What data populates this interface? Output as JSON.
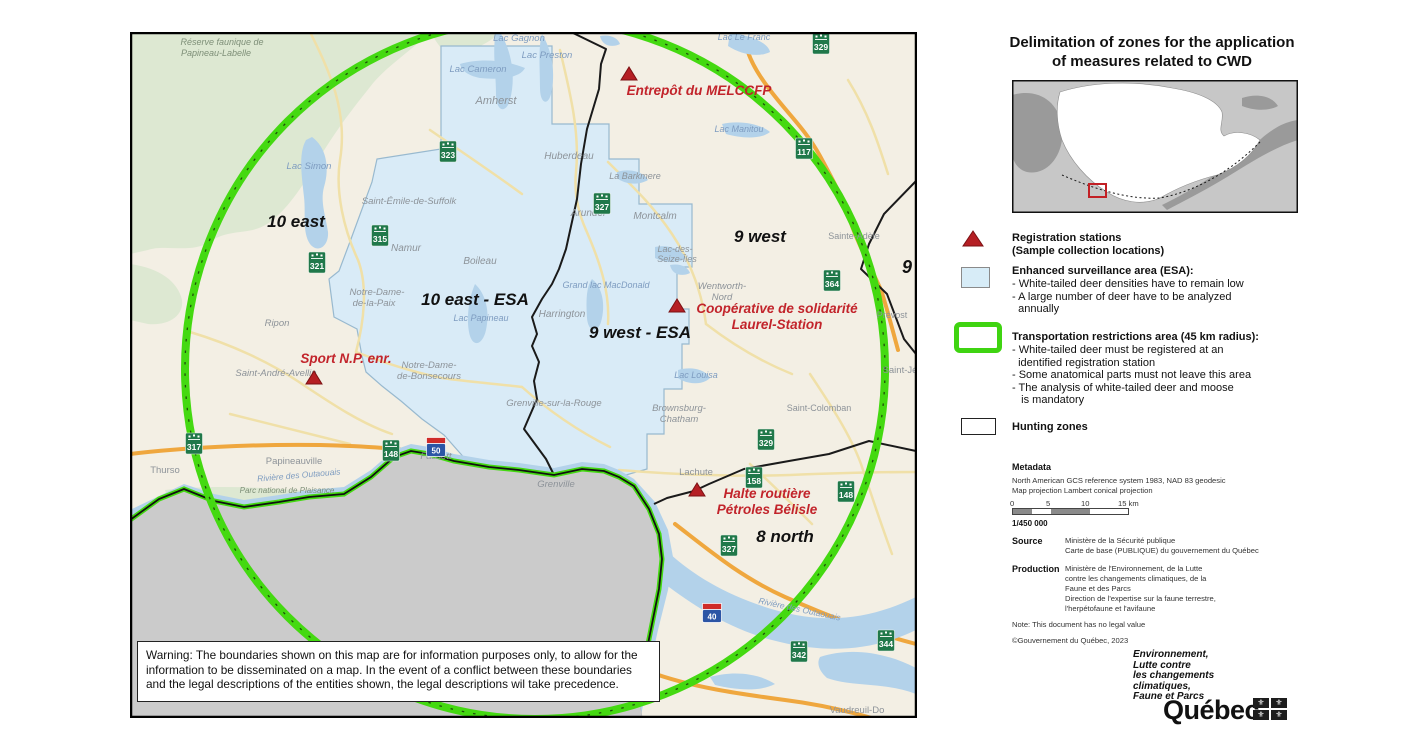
{
  "title": {
    "line1": "Delimitation of zones for the application",
    "line2": "of measures related to CWD"
  },
  "legend": {
    "registration_line1": "Registration stations",
    "registration_line2": "(Sample collection locations)",
    "esa_header": "Enhanced surveillance area (ESA):",
    "esa_items": [
      "- White-tailed deer densities have to remain low",
      "- A large number of deer have to be analyzed",
      "  annually"
    ],
    "transport_header": "Transportation restrictions area (45 km radius):",
    "transport_items": [
      "- White-tailed deer must be registered at an",
      "  identified registration station",
      "- Some anatomical parts must not leave this area",
      "- The analysis of white-tailed deer and moose",
      "   is mandatory"
    ],
    "hunting_label": "Hunting zones"
  },
  "metadata": {
    "header": "Metadata",
    "line1": "North American GCS reference system 1983, NAD 83 geodesic",
    "line2": "Map projection Lambert conical projection",
    "scale_ticks": [
      "0",
      "5",
      "10",
      "15 km"
    ],
    "scale_ratio": "1/450 000",
    "source_label": "Source",
    "source_lines": [
      "Ministère de la Sécurité publique",
      "Carte de base (PUBLIQUE) du gouvernement du Québec"
    ],
    "production_label": "Production",
    "production_lines": [
      "Ministère de l'Environnement, de la Lutte",
      "contre les changements climatiques, de la",
      "Faune et des Parcs",
      "Direction de l'expertise sur la faune terrestre,",
      "l'herpétofaune et l'avifaune"
    ],
    "note": "Note: This document has no legal value",
    "copyright": "©Gouvernement du Québec, 2023"
  },
  "logo": {
    "lines": [
      "Environnement,",
      "Lutte contre",
      "les changements",
      "climatiques,",
      "Faune et Parcs"
    ],
    "wordmark": "Québec",
    "fleur": "⚜"
  },
  "warning": {
    "lines": [
      "Warning: The boundaries shown on this map are for information purposes only, to allow for the",
      "information to be disseminated on a map. In the event of a conflict between these boundaries",
      "and the legal descriptions of the entities shown, the legal descriptions wil take precedence."
    ]
  },
  "map": {
    "colors": {
      "circle_green": "#44d911",
      "esa_fill": "#d9ebf7",
      "station_red": "#c2242b",
      "shield_green": "#20784a",
      "autoroute_blue": "#2c55a5",
      "autoroute_red": "#cf2b28",
      "ontario_gray": "#cbcbcb"
    },
    "zones": [
      {
        "t": "10 east",
        "x": 166,
        "y": 195,
        "s": 17
      },
      {
        "t": "10 east - ESA",
        "x": 345,
        "y": 273,
        "s": 17
      },
      {
        "t": "9 west",
        "x": 630,
        "y": 210,
        "s": 17
      },
      {
        "t": "9 west - ESA",
        "x": 510,
        "y": 306,
        "s": 17
      },
      {
        "t": "8 north",
        "x": 655,
        "y": 510,
        "s": 17
      },
      {
        "t": "9",
        "x": 777,
        "y": 241,
        "s": 18
      }
    ],
    "stations": [
      {
        "tx": 499,
        "ty": 43,
        "lines": [
          {
            "t": "Entrepôt du MELCCFP",
            "x": 569,
            "y": 63
          }
        ]
      },
      {
        "tx": 547,
        "ty": 275,
        "lines": [
          {
            "t": "Coopérative de solidarité",
            "x": 647,
            "y": 281
          },
          {
            "t": "Laurel-Station",
            "x": 647,
            "y": 297
          }
        ]
      },
      {
        "tx": 184,
        "ty": 347,
        "lines": [
          {
            "t": "Sport N.P. enr.",
            "x": 216,
            "y": 331
          }
        ]
      },
      {
        "tx": 567,
        "ty": 459,
        "lines": [
          {
            "t": "Halte routière",
            "x": 637,
            "y": 466
          },
          {
            "t": "Pétroles Bélisle",
            "x": 637,
            "y": 482
          }
        ]
      }
    ],
    "towns": [
      {
        "t": "Amherst",
        "x": 366,
        "y": 72,
        "s": 11,
        "it": 1
      },
      {
        "t": "Huberdeau",
        "x": 439,
        "y": 127,
        "s": 10,
        "it": 1
      },
      {
        "t": "La Barkmere",
        "x": 505,
        "y": 147,
        "s": 9,
        "it": 1
      },
      {
        "t": "Arundel",
        "x": 458,
        "y": 184,
        "s": 10,
        "it": 1
      },
      {
        "t": "Montcalm",
        "x": 525,
        "y": 187,
        "s": 10,
        "it": 1
      },
      {
        "t": "Saint-Émile-de-Suffolk",
        "x": 279,
        "y": 172,
        "s": 9.5,
        "it": 1
      },
      {
        "t": "Namur",
        "x": 276,
        "y": 219,
        "s": 10,
        "it": 1
      },
      {
        "t": "Boileau",
        "x": 350,
        "y": 232,
        "s": 10,
        "it": 1
      },
      {
        "t": "Notre-Dame-",
        "x": 247,
        "y": 263,
        "s": 9.5,
        "it": 1
      },
      {
        "t": "de-la-Paix",
        "x": 244,
        "y": 274,
        "s": 9.5,
        "it": 1
      },
      {
        "t": "Ripon",
        "x": 147,
        "y": 294,
        "s": 9.5,
        "it": 1
      },
      {
        "t": "Saint-André-Avellin",
        "x": 146,
        "y": 344,
        "s": 9.5,
        "it": 1
      },
      {
        "t": "Notre-Dame-",
        "x": 299,
        "y": 336,
        "s": 9.5,
        "it": 1
      },
      {
        "t": "de-Bonsecours",
        "x": 299,
        "y": 347,
        "s": 9.5,
        "it": 1
      },
      {
        "t": "Harrington",
        "x": 432,
        "y": 285,
        "s": 10,
        "it": 1
      },
      {
        "t": "Wentworth-",
        "x": 592,
        "y": 257,
        "s": 9.5,
        "it": 1
      },
      {
        "t": "Nord",
        "x": 592,
        "y": 268,
        "s": 9.5,
        "it": 1
      },
      {
        "t": "Lac-des-",
        "x": 545,
        "y": 220,
        "s": 9,
        "it": 1
      },
      {
        "t": "Seize-Îles",
        "x": 547,
        "y": 230,
        "s": 9,
        "it": 1
      },
      {
        "t": "Grenville-sur-la-Rouge",
        "x": 424,
        "y": 374,
        "s": 9.5,
        "it": 1
      },
      {
        "t": "Brownsburg-",
        "x": 549,
        "y": 379,
        "s": 9.5,
        "it": 1
      },
      {
        "t": "Chatham",
        "x": 549,
        "y": 390,
        "s": 9.5,
        "it": 1
      },
      {
        "t": "Sainte-Adèle",
        "x": 724,
        "y": 207,
        "s": 9,
        "it": 0
      },
      {
        "t": "Prévost",
        "x": 762,
        "y": 286,
        "s": 9,
        "it": 0
      },
      {
        "t": "Saint-Jé",
        "x": 770,
        "y": 341,
        "s": 9.5,
        "it": 0
      },
      {
        "t": "Saint-Colomban",
        "x": 689,
        "y": 379,
        "s": 9,
        "it": 0
      },
      {
        "t": "Papineauville",
        "x": 164,
        "y": 432,
        "s": 9.5,
        "it": 0
      },
      {
        "t": "Thurso",
        "x": 35,
        "y": 441,
        "s": 9.5,
        "it": 0
      },
      {
        "t": "Fassett",
        "x": 306,
        "y": 427,
        "s": 9.5,
        "it": 1
      },
      {
        "t": "Grenville",
        "x": 426,
        "y": 455,
        "s": 9.5,
        "it": 1
      },
      {
        "t": "Lachute",
        "x": 566,
        "y": 443,
        "s": 9.5,
        "it": 0
      },
      {
        "t": "Vaudreuil-Do",
        "x": 727,
        "y": 681,
        "s": 9.5,
        "it": 0
      }
    ],
    "water_labels": [
      {
        "t": "Lac Gagnon",
        "x": 389,
        "y": 9,
        "s": 9.5,
        "r": 0
      },
      {
        "t": "Lac Preston",
        "x": 417,
        "y": 26,
        "s": 9.5,
        "r": 0
      },
      {
        "t": "Lac Le Franc",
        "x": 614,
        "y": 8,
        "s": 9,
        "r": 0
      },
      {
        "t": "Lac Cameron",
        "x": 348,
        "y": 40,
        "s": 9.5,
        "r": 0
      },
      {
        "t": "Lac Simon",
        "x": 179,
        "y": 137,
        "s": 9.5,
        "r": 0
      },
      {
        "t": "Lac Papineau",
        "x": 351,
        "y": 289,
        "s": 9,
        "r": 0
      },
      {
        "t": "Grand lac MacDonald",
        "x": 476,
        "y": 256,
        "s": 9,
        "r": 0
      },
      {
        "t": "Lac Louisa",
        "x": 566,
        "y": 346,
        "s": 9,
        "r": 0
      },
      {
        "t": "Lac Manitou",
        "x": 609,
        "y": 100,
        "s": 9,
        "r": 0
      },
      {
        "t": "Rivière des Outaouais",
        "x": 169,
        "y": 446,
        "s": 8.5,
        "r": -5
      },
      {
        "t": "Rivière des Outaouais",
        "x": 669,
        "y": 580,
        "s": 8.5,
        "r": 12
      }
    ],
    "green_labels": [
      {
        "t": "Réserve faunique de",
        "x": 47,
        "y": 13,
        "s": 9
      },
      {
        "t": "Papineau-Labelle",
        "x": 41,
        "y": 24,
        "s": 9
      },
      {
        "t": "Parc national de Plaisance",
        "x": 112,
        "y": 461,
        "s": 8
      }
    ],
    "route_shields": [
      {
        "n": "323",
        "x": 318,
        "y": 119
      },
      {
        "n": "315",
        "x": 250,
        "y": 203
      },
      {
        "n": "321",
        "x": 187,
        "y": 230
      },
      {
        "n": "329",
        "x": 691,
        "y": 11
      },
      {
        "n": "117",
        "x": 674,
        "y": 116
      },
      {
        "n": "327",
        "x": 472,
        "y": 171
      },
      {
        "n": "364",
        "x": 702,
        "y": 248
      },
      {
        "n": "329",
        "x": 636,
        "y": 407
      },
      {
        "n": "317",
        "x": 64,
        "y": 411
      },
      {
        "n": "148",
        "x": 261,
        "y": 418
      },
      {
        "n": "158",
        "x": 624,
        "y": 445
      },
      {
        "n": "148",
        "x": 716,
        "y": 459
      },
      {
        "n": "327",
        "x": 599,
        "y": 513
      },
      {
        "n": "342",
        "x": 669,
        "y": 619
      },
      {
        "n": "344",
        "x": 756,
        "y": 608
      }
    ],
    "autoroute_shields": [
      {
        "n": "50",
        "x": 306,
        "y": 414
      },
      {
        "n": "40",
        "x": 582,
        "y": 580
      }
    ]
  }
}
